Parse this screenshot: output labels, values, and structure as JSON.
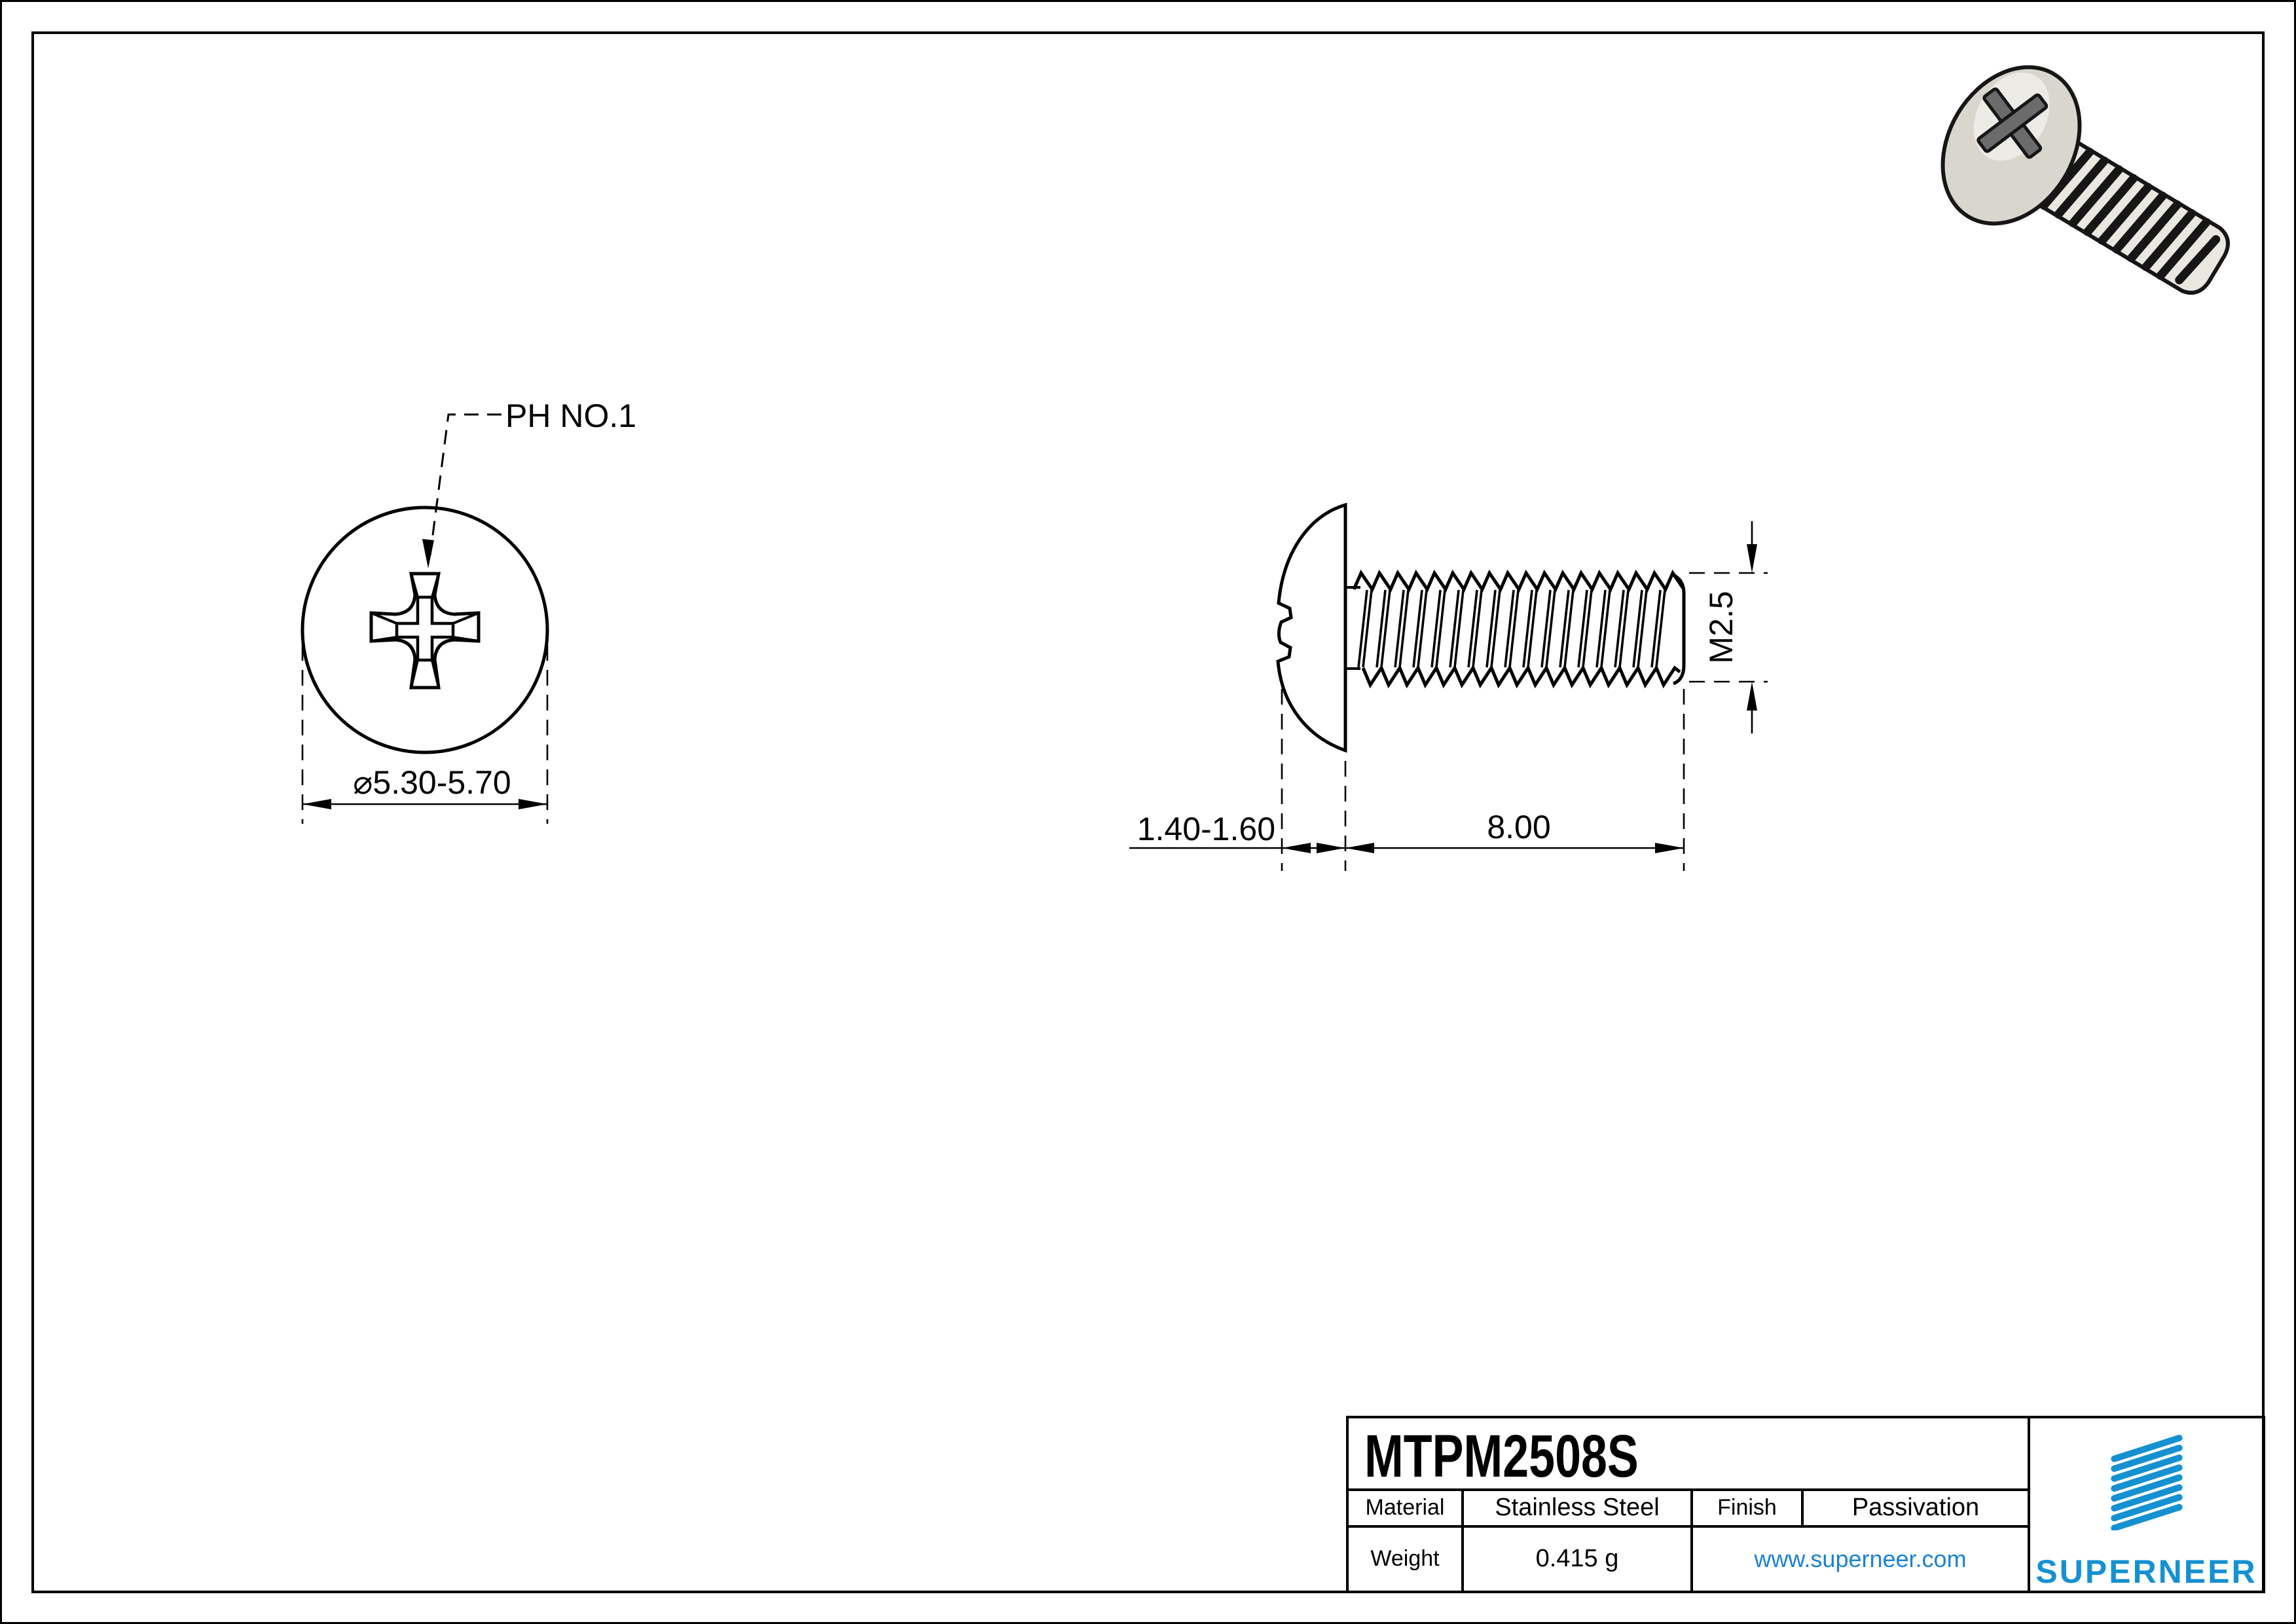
{
  "drawing": {
    "front_view": {
      "callout": "PH NO.1",
      "diameter_dim": "⌀5.30-5.70"
    },
    "side_view": {
      "head_height_dim": "1.40-1.60",
      "length_dim": "8.00",
      "thread_dim": "M2.5"
    }
  },
  "title_block": {
    "part_number": "MTPM2508S",
    "description_line1": "M2.5 X 8 mm  Truss Head Phillips Machine",
    "description_line2": "Screw SUS304 Stainless Steel JIS B 1111",
    "material": {
      "label": "Material",
      "value": "Stainless Steel"
    },
    "finish": {
      "label": "Finish",
      "value": "Passivation"
    },
    "weight": {
      "label": "Weight",
      "value": "0.415 g"
    },
    "website": "www.superneer.com",
    "brand": "SUPERNEER"
  },
  "colors": {
    "logo_blue": "#1591d1",
    "link_blue": "#1b82d2",
    "line_black": "#000000",
    "screw_body_fill": "#e9e7e0",
    "screw_head_fill": "#d9d6cd",
    "screw_cross_fill": "#6b6b6b"
  }
}
